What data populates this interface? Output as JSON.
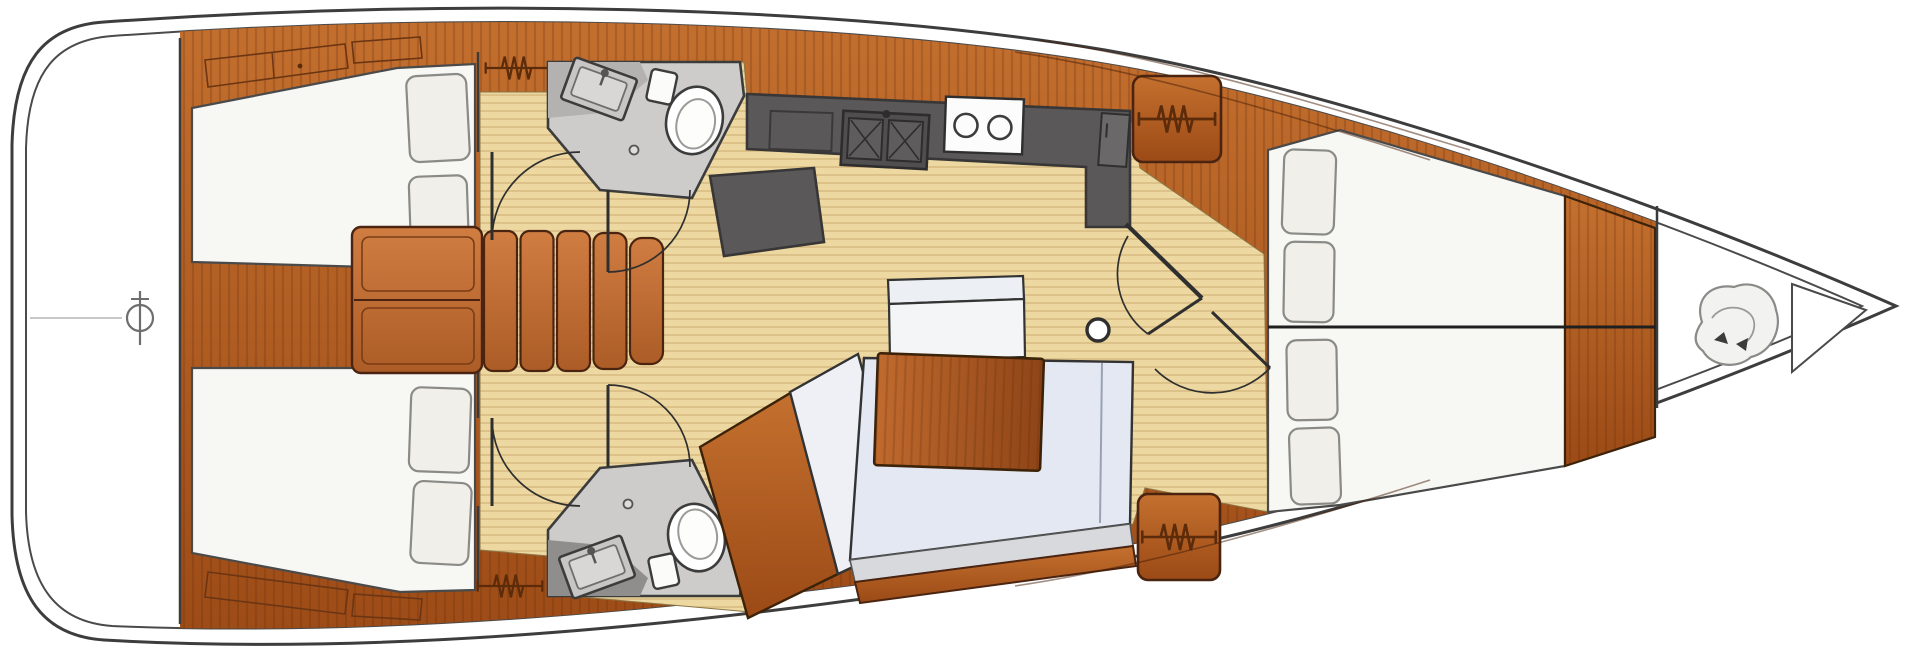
{
  "meta": {
    "description": "Sailing yacht interior layout deck plan, top-down view, bow to the right",
    "diagram_type": "yacht-floor-plan"
  },
  "colors": {
    "background": "#ffffff",
    "hull_stroke": "#3d3d3d",
    "wood_light": "#c4702f",
    "wood_dark": "#9c4a16",
    "wood_step_light": "#d07d42",
    "wood_step_dark": "#ac5c26",
    "table_light": "#c06a2e",
    "table_dark": "#8f4517",
    "floor": "#ecd8a0",
    "floor_line": "#d2b377",
    "counter": "#5a5858",
    "counter_stroke": "#383636",
    "head_floor": "#cdcccb",
    "head_counter_top": "#b3b2b1",
    "head_counter_bottom": "#8f8e8d",
    "bed": "#f7f7f4",
    "pillow": "#f1efe9",
    "sofa_seat": "#e3e8f2",
    "sofa_chaise": "#eef0f5",
    "sofa_trim": "#d7d9dd",
    "bench": "#f4f5f7",
    "detail_stroke": "#6b3513",
    "symbol_stroke": "#5c2b0a"
  },
  "rooms": {
    "stern_platform": {
      "name": "stern platform",
      "symbol": "windlass-crosshair"
    },
    "aft_cabin_port": {
      "name": "aft cabin (port)",
      "berth": "double",
      "pillows": 2,
      "wardrobe": "hanging-locker"
    },
    "aft_cabin_starboard": {
      "name": "aft cabin (starboard)",
      "berth": "double",
      "pillows": 2,
      "wardrobe": "hanging-locker"
    },
    "head_port": {
      "name": "aft head (port)",
      "fixtures": [
        "toilet",
        "sink"
      ]
    },
    "head_starboard": {
      "name": "aft head (starboard)",
      "fixtures": [
        "toilet",
        "sink"
      ]
    },
    "companionway": {
      "name": "companionway",
      "steps": 5
    },
    "galley": {
      "name": "galley",
      "fixtures": [
        "icebox",
        "double-sink",
        "two-burner-stove",
        "refrigerator"
      ]
    },
    "salon": {
      "name": "salon",
      "furniture": [
        "bench-seat",
        "dining-table",
        "l-shaped-sofa",
        "chaise",
        "mast-compression-post"
      ]
    },
    "forward_cabin": {
      "name": "forward cabin",
      "berth": "v-berth double",
      "pillows": 4,
      "wardrobes": 2
    },
    "anchor_locker": {
      "name": "anchor locker",
      "contents": "anchor-rode"
    }
  },
  "symbols": {
    "hanging_locker": "zigzag-hanger",
    "door": "quarter-circle-swing",
    "stove": "two-burner-circles",
    "sink_galley": "double-basin-x"
  },
  "counts": {
    "hanging_lockers": 4,
    "doors": 6,
    "cabins": 3,
    "heads": 2
  }
}
